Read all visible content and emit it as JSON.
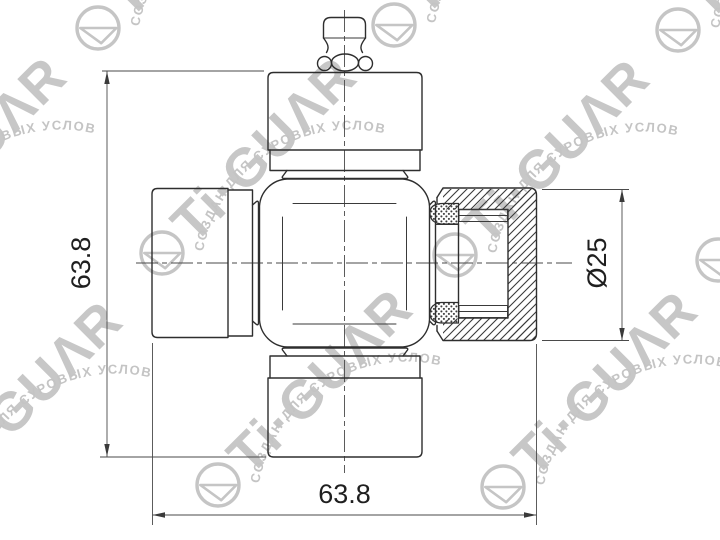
{
  "drawing": {
    "type": "technical-drawing",
    "subject": "universal joint cross with bearing cups, one cup in section",
    "dimensions": {
      "height": "63.8",
      "width": "63.8",
      "diameter": "Ø25"
    },
    "watermark": {
      "brand": "Ti·GUΛR",
      "tagline": "СОЗДАН ДЛЯ СУРОВЫХ УСЛОВИЙ",
      "logo_icon": "circle-sail-logo",
      "color": "#c7c7c7"
    },
    "line_color": "#2e2e2e",
    "background_color": "#ffffff"
  }
}
